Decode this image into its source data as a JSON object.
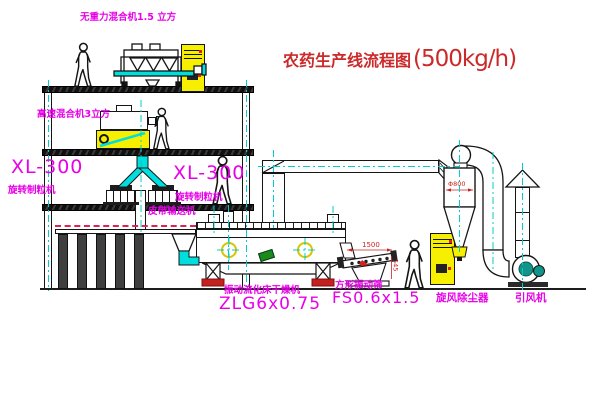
{
  "title": {
    "name": "农药生产线流程图",
    "capacity": "(500kg/h)"
  },
  "equipment_labels": {
    "gravity_mixer": "无重力混合机1.5 立方",
    "high_speed_mixer": "高速混合机3立方",
    "granulator_left_model": "XL-300",
    "granulator_left_name": "旋转制粒机",
    "granulator_center_model": "XL-300",
    "granulator_center_name": "旋转制粒机",
    "belt_conveyor": "皮带输送机",
    "fluid_bed_dryer_name": "振动流化床干燥机",
    "fluid_bed_dryer_model": "ZLG6x0.75",
    "square_vibrating_screen_name": "方形振动筛",
    "square_vibrating_screen_model": "FS0.6x1.5",
    "cyclone_dust_collector": "旋风除尘器",
    "induced_draft_fan": "引风机"
  },
  "dimensions": {
    "cyclone_diameter": "Φ800",
    "screen_length": "1500",
    "screen_height": "545"
  },
  "colors": {
    "label_magenta": "#e800e8",
    "title_red": "#cc2a2a",
    "pipe_cyan": "#00dede",
    "equipment_yellow": "#f7ef00",
    "fan_teal": "#12948a",
    "accent_green": "#1a8a1a",
    "conveyor_dash_red": "#dd2255",
    "foot_red": "#c42020"
  }
}
